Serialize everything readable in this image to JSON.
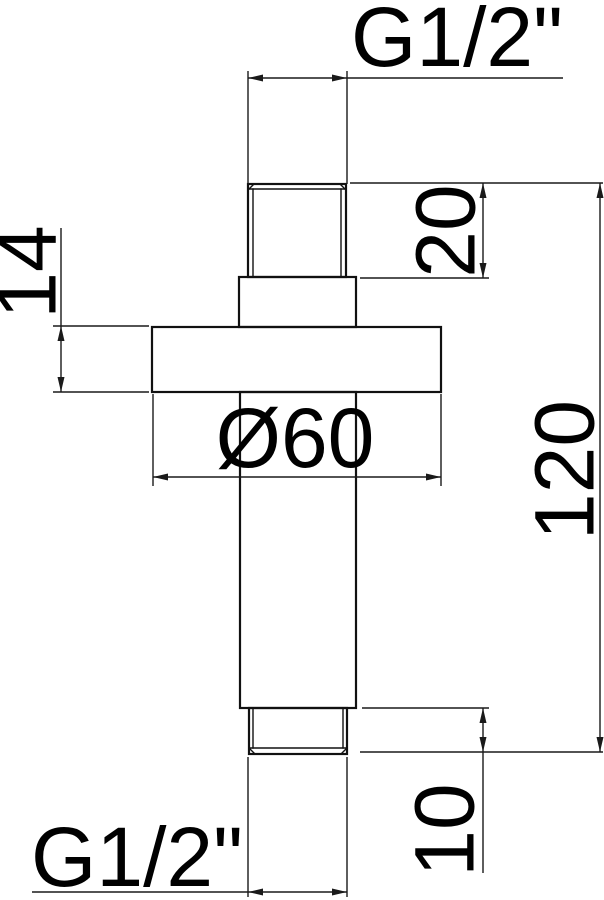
{
  "drawing": {
    "type": "technical-dimension-drawing",
    "part": "ceiling shower arm",
    "background_color": "#ffffff",
    "line_color": "#111111",
    "labels": {
      "top_thread": "G1/2\"",
      "bottom_thread": "G1/2\""
    },
    "dimensions": {
      "top_thread_length": "20",
      "flange_thickness": "14",
      "flange_diameter": "Ø60",
      "overall_length": "120",
      "bottom_thread_length": "10"
    }
  }
}
